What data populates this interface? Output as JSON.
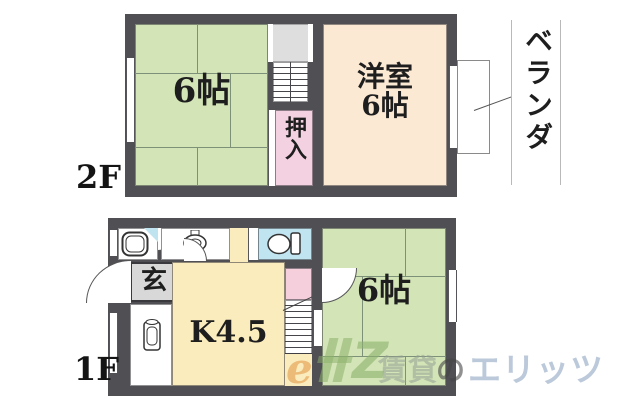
{
  "plan": {
    "floor_2f": {
      "floor_label": "2F",
      "tatami_room_label": "6帖",
      "closet_label": "押入",
      "western_room_name": "洋室",
      "western_room_size": "6帖",
      "balcony_label": "ベランダ"
    },
    "floor_1f": {
      "floor_label": "1F",
      "kitchen_label": "K4.5",
      "entrance_label": "玄",
      "tatami_room_label": "6帖"
    }
  },
  "watermark": {
    "logo_e": "e",
    "logo_z": "Z",
    "brand_rental": "賃貸",
    "brand_no": "の",
    "brand_elitz": "エリッツ"
  },
  "colors": {
    "wall": "#4f4f54",
    "tatami_green": "#d3e5b6",
    "western_cream": "#fce9d4",
    "closet_pink": "#f4d1e1",
    "kitchen_yellow": "#faecbd",
    "toilet_cyan": "#c0e4f0",
    "stair_landing_gray": "#dedede",
    "entrance_gray": "#d8d8d8",
    "stair_pink": "#f6cfdd"
  }
}
